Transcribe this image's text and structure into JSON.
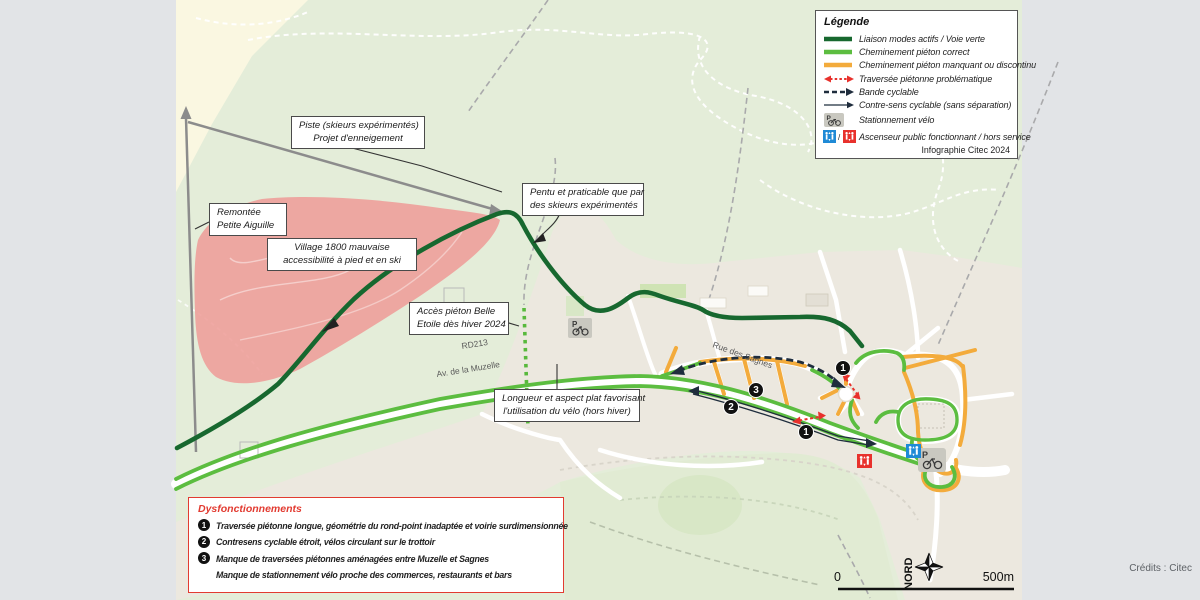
{
  "legend": {
    "title": "Légende",
    "footer": "Infographie Citec 2024",
    "items": [
      {
        "label": "Liaison modes actifs / Voie verte",
        "color": "#17682f"
      },
      {
        "label": "Cheminement piéton correct",
        "color": "#5cbd40"
      },
      {
        "label": "Cheminement piéton manquant ou discontinu",
        "color": "#f3ab3c"
      },
      {
        "label": "Traversée piétonne problématique",
        "color": "#e8312c"
      },
      {
        "label": "Bande cyclable",
        "color": "#1f2d3d"
      },
      {
        "label": "Contre-sens cyclable (sans séparation)",
        "color": "#1f2d3d"
      },
      {
        "label": "Stationnement vélo",
        "color": "#b9b8b0"
      },
      {
        "label": "Ascenseur public fonctionnant / hors service",
        "color_ok": "#1f8ad6",
        "color_ko": "#e8312c"
      }
    ]
  },
  "annotations": {
    "piste": {
      "line1": "Piste (skieurs expérimentés)",
      "line2": "Projet d'enneigement"
    },
    "remontee": {
      "line1": "Remontée",
      "line2": "Petite Aiguille"
    },
    "village": {
      "line1": "Village 1800 mauvaise",
      "line2": "accessibilité à pied et en ski"
    },
    "pentu": {
      "line1": "Pentu et praticable que par",
      "line2": "des skieurs expérimentés"
    },
    "acces": {
      "line1": "Accès piéton Belle",
      "line2": "Etoile dès hiver 2024"
    },
    "longueur": {
      "line1": "Longueur et aspect plat favorisant",
      "line2": "l'utilisation du vélo (hors hiver)"
    }
  },
  "roads": {
    "rd213": "RD213",
    "muzelle": "Av. de la Muzelle",
    "sagnes": "Rue des Sagnes"
  },
  "issues": {
    "title": "Dysfonctionnements",
    "items": [
      {
        "num": "1",
        "text": "Traversée piétonne longue, géométrie du rond-point inadaptée et voirie surdimensionnée"
      },
      {
        "num": "2",
        "text": "Contresens cyclable étroit, vélos circulant sur le trottoir"
      },
      {
        "num": "3",
        "text": "Manque de traversées piétonnes aménagées entre Muzelle et Sagnes"
      },
      {
        "num": "",
        "text": "Manque de stationnement vélo proche des commerces, restaurants et bars"
      }
    ]
  },
  "markers": {
    "m1": "1",
    "m2": "2",
    "m3": "3"
  },
  "scalebar": {
    "zero": "0",
    "five": "500m",
    "north": "NORD"
  },
  "credits": "Crédits : Citec",
  "icons": {
    "bike_p": "P"
  }
}
